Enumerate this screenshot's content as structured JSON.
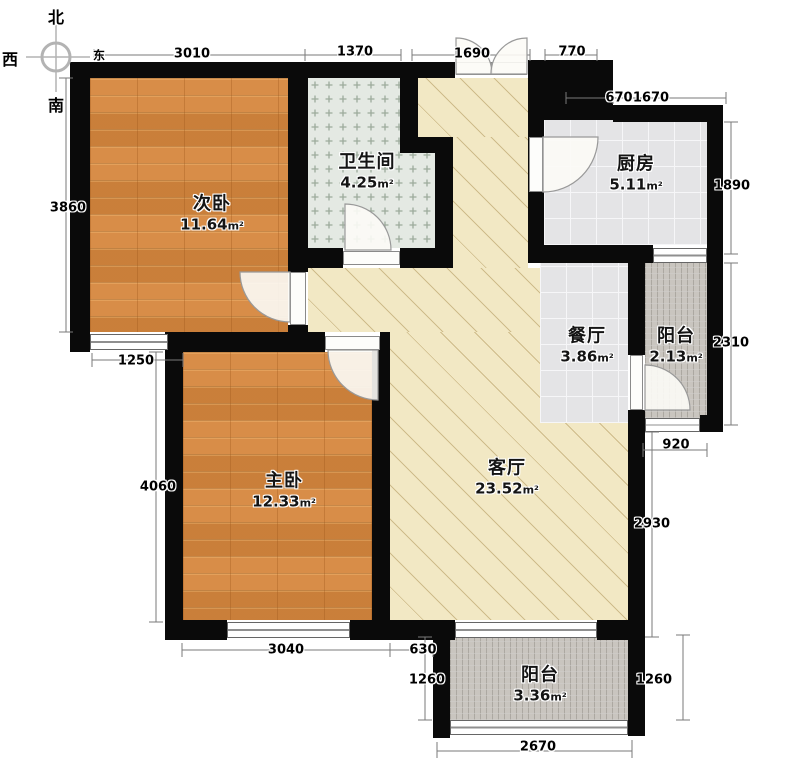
{
  "compass": {
    "north": "北",
    "west": "西",
    "south": "南",
    "east": "东"
  },
  "rooms": [
    {
      "name": "次卧",
      "area": "11.64",
      "unit": "m²"
    },
    {
      "name": "卫生间",
      "area": "4.25",
      "unit": "m²"
    },
    {
      "name": "厨房",
      "area": "5.11",
      "unit": "m²"
    },
    {
      "name": "餐厅",
      "area": "3.86",
      "unit": "m²"
    },
    {
      "name": "阳台",
      "area": "2.13",
      "unit": "m²"
    },
    {
      "name": "主卧",
      "area": "12.33",
      "unit": "m²"
    },
    {
      "name": "客厅",
      "area": "23.52",
      "unit": "m²"
    },
    {
      "name": "阳台",
      "area": "3.36",
      "unit": "m²"
    }
  ],
  "dimensions": {
    "top": [
      "3010",
      "1370",
      "1690",
      "770"
    ],
    "top_inner": [
      "670",
      "1670"
    ],
    "right": [
      "1890",
      "2310",
      "920",
      "2930",
      "1260"
    ],
    "left": [
      "3860",
      "1250",
      "4060",
      "1260"
    ],
    "bottom": [
      "3040",
      "630",
      "2670"
    ]
  },
  "colors": {
    "wall": "#0a0a0a",
    "wood_floor": "#d6873e",
    "tile_floor": "#e4e4e6",
    "bath_tile": "#e4e9e3",
    "living_floor": "#f2e8c4",
    "balcony_tile": "#c9c5bf",
    "dimension_line": "#7a7a7a"
  }
}
